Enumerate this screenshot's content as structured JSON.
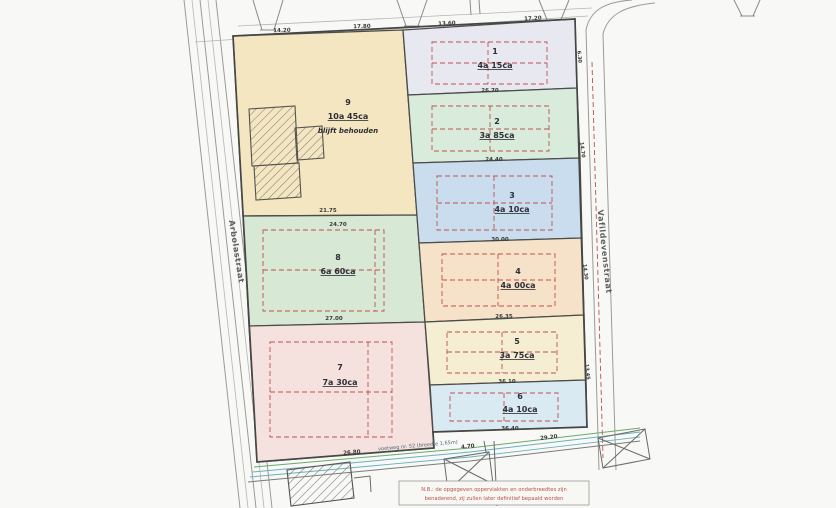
{
  "parcels": [
    {
      "number": "1",
      "area": "4a 15ca"
    },
    {
      "number": "2",
      "area": "3a 85ca"
    },
    {
      "number": "3",
      "area": "4a 10ca"
    },
    {
      "number": "4",
      "area": "4a 00ca"
    },
    {
      "number": "5",
      "area": "3a 75ca"
    },
    {
      "number": "6",
      "area": "4a 10ca"
    },
    {
      "number": "7",
      "area": "7a 30ca"
    },
    {
      "number": "8",
      "area": "6a 60ca"
    },
    {
      "number": "9",
      "area": "10a 45ca",
      "note": "blijft behouden"
    }
  ],
  "streets": {
    "left": "Arbolastraat",
    "right": "Vafildevenstraat",
    "bottom": "voetweg nr. 52 (breedte 1,65m)"
  },
  "note": {
    "line1": "N.B.: de opgegeven oppervlakten en onderbreedtes zijn",
    "line2": "benaderend, zij zullen later definitief bepaald worden"
  },
  "dims": {
    "top": [
      "14.20",
      "17.80",
      "13.60",
      "17.20"
    ],
    "inner": [
      "21.75",
      "24.70",
      "27.00",
      "26.70",
      "24.40",
      "30.00",
      "26.35",
      "36.10",
      "36.40"
    ],
    "bottom": [
      "26.80",
      "4.70",
      "29.20"
    ],
    "right": [
      "6.30",
      "14.70",
      "14.30",
      "13.45"
    ]
  },
  "colors": {
    "p1": "#e7e8f0",
    "p2": "#d9ecdb",
    "p3": "#c9ddef",
    "p4": "#f6e2c8",
    "p5": "#f5eed2",
    "p6": "#d9eaf2",
    "p7": "#f5e2de",
    "p8": "#d7e8d4",
    "p9": "#f3e6c0",
    "boundary_red": "#c0504d",
    "outline": "#464644",
    "road_green": "#6aa96a",
    "road_teal": "#6ab0bd"
  }
}
